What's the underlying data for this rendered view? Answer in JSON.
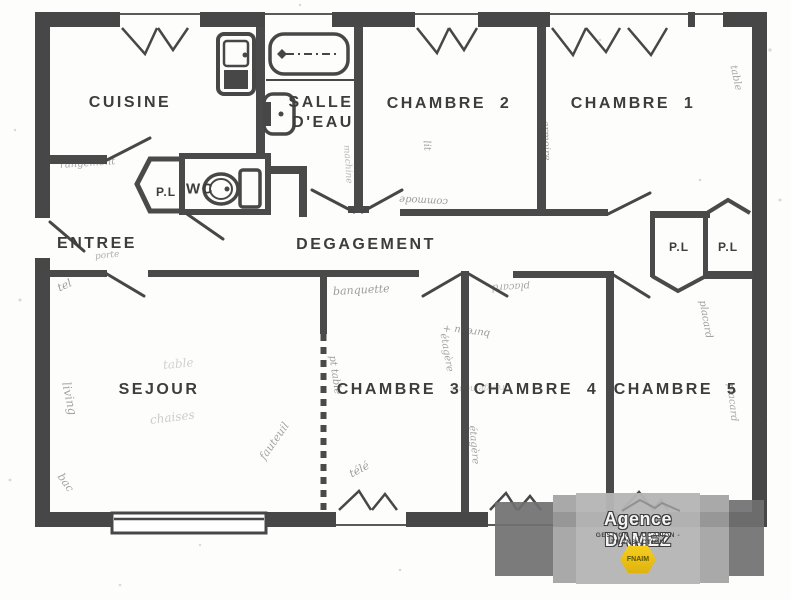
{
  "labels": {
    "cuisine": "CUISINE",
    "salle_line1": "SALLE",
    "salle_line2": "D'EAU",
    "chambre2": "CHAMBRE  2",
    "chambre1": "CHAMBRE  1",
    "entree": "ENTREE",
    "pl_wc": "P.L",
    "wc": "WC",
    "degagement": "DEGAGEMENT",
    "pl_right_a": "P.L",
    "pl_right_b": "P.L",
    "sejour": "SEJOUR",
    "chambre3": "CHAMBRE  3",
    "chambre4": "CHAMBRE  4",
    "chambre5": "CHAMBRE  5"
  },
  "watermark": {
    "agency": "Agence DAMEZ",
    "tagline": "GESTION - LOCATION - TRANSACTION",
    "badge": "FNAIM"
  },
  "colors": {
    "wall": "#474747",
    "label": "#3d3d3d",
    "watermark_dark": "#707070",
    "watermark_mid": "#a0a0a0",
    "watermark_light": "#b5b5b5",
    "fnaim_yellow": "#f2c413"
  },
  "icons": [
    "bathtub-icon",
    "kitchen-sink-icon",
    "washbasin-icon",
    "toilet-icon",
    "fnaim-diamond-icon",
    "closet-pentagon-icon"
  ],
  "annotations": [
    {
      "text": "rangement",
      "x": 60,
      "y": 160,
      "rot": -4,
      "fs": 10,
      "op": 0.5
    },
    {
      "text": "porte",
      "x": 95,
      "y": 252,
      "rot": -6,
      "fs": 9,
      "op": 0.45
    },
    {
      "text": "tel",
      "x": 58,
      "y": 282,
      "rot": -25,
      "fs": 11,
      "op": 0.55
    },
    {
      "text": "living",
      "x": 66,
      "y": 375,
      "rot": 78,
      "fs": 12,
      "op": 0.5
    },
    {
      "text": "bac",
      "x": 60,
      "y": 468,
      "rot": 55,
      "fs": 11,
      "op": 0.5
    },
    {
      "text": "table",
      "x": 163,
      "y": 358,
      "rot": -5,
      "fs": 12,
      "op": 0.25
    },
    {
      "text": "chaises",
      "x": 150,
      "y": 413,
      "rot": -7,
      "fs": 12,
      "op": 0.28
    },
    {
      "text": "fauteuil",
      "x": 262,
      "y": 452,
      "rot": -55,
      "fs": 11,
      "op": 0.5
    },
    {
      "text": "banquette",
      "x": 333,
      "y": 285,
      "rot": -3,
      "fs": 11,
      "op": 0.55
    },
    {
      "text": "pt table",
      "x": 332,
      "y": 350,
      "rot": 82,
      "fs": 10,
      "op": 0.55
    },
    {
      "text": "télé",
      "x": 350,
      "y": 468,
      "rot": -28,
      "fs": 11,
      "op": 0.55
    },
    {
      "text": "étagère",
      "x": 443,
      "y": 328,
      "rot": 80,
      "fs": 10,
      "op": 0.5
    },
    {
      "text": "étagère",
      "x": 472,
      "y": 420,
      "rot": 85,
      "fs": 10,
      "op": 0.5
    },
    {
      "text": "bureau +",
      "x": 490,
      "y": 328,
      "rot": 187,
      "fs": 10,
      "op": 0.55
    },
    {
      "text": "rangements",
      "x": 505,
      "y": 382,
      "rot": 178,
      "fs": 9,
      "op": 0.32
    },
    {
      "text": "placard",
      "x": 530,
      "y": 280,
      "rot": 177,
      "fs": 10,
      "op": 0.5
    },
    {
      "text": "machine",
      "x": 346,
      "y": 140,
      "rot": 86,
      "fs": 9,
      "op": 0.4
    },
    {
      "text": "commode",
      "x": 448,
      "y": 196,
      "rot": 183,
      "fs": 10,
      "op": 0.55
    },
    {
      "text": "armoire",
      "x": 545,
      "y": 115,
      "rot": 88,
      "fs": 10,
      "op": 0.55
    },
    {
      "text": "lit",
      "x": 426,
      "y": 135,
      "rot": 84,
      "fs": 10,
      "op": 0.5
    },
    {
      "text": "table",
      "x": 733,
      "y": 60,
      "rot": 78,
      "fs": 10,
      "op": 0.5
    },
    {
      "text": "placard",
      "x": 702,
      "y": 295,
      "rot": 80,
      "fs": 10,
      "op": 0.55
    },
    {
      "text": "placard",
      "x": 730,
      "y": 378,
      "rot": 84,
      "fs": 10,
      "op": 0.5
    }
  ]
}
